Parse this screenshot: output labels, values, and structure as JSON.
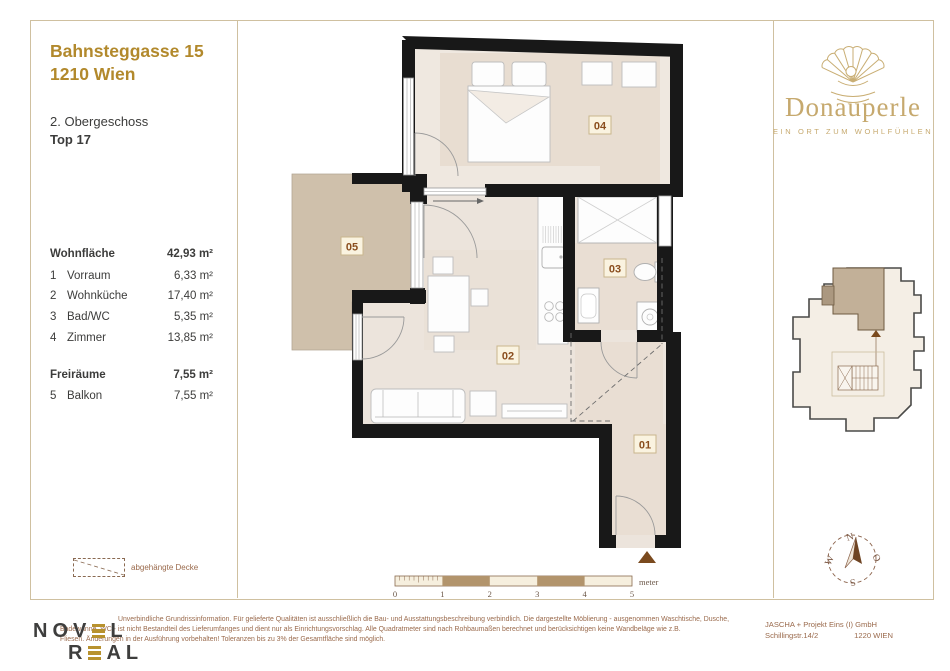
{
  "project": {
    "title1": "Bahnsteggasse 15",
    "title2": "1210 Wien",
    "floor": "2. Obergeschoss",
    "unit": "Top 17"
  },
  "brand": {
    "name": "Donauperle",
    "tagline": "EIN ORT ZUM WOHLFÜHLEN"
  },
  "areas": {
    "h1": {
      "label": "Wohnfläche",
      "value": "42,93 m²"
    },
    "rows": [
      {
        "no": "1",
        "label": "Vorraum",
        "value": "6,33 m²"
      },
      {
        "no": "2",
        "label": "Wohnküche",
        "value": "17,40 m²"
      },
      {
        "no": "3",
        "label": "Bad/WC",
        "value": "5,35 m²"
      },
      {
        "no": "4",
        "label": "Zimmer",
        "value": "13,85 m²"
      }
    ],
    "h2": {
      "label": "Freiräume",
      "value": "7,55 m²"
    },
    "rows2": [
      {
        "no": "5",
        "label": "Balkon",
        "value": "7,55 m²"
      }
    ]
  },
  "legend": {
    "label": "abgehängte Decke"
  },
  "plan": {
    "badges": [
      "01",
      "02",
      "03",
      "04",
      "05"
    ]
  },
  "scale": {
    "ticks": [
      "0",
      "1",
      "2",
      "3",
      "4",
      "5"
    ],
    "unit": "meter"
  },
  "compass": {
    "n": "N",
    "o": "O",
    "s": "S",
    "w": "W"
  },
  "footer": {
    "logo": {
      "l1a": "NOV",
      "l1b": "L",
      "l2a": "R",
      "l2b": "AL"
    },
    "disclaimer": [
      "Unverbindliche Grundrissinformation. Für gelieferte Qualitäten ist ausschließlich die Bau- und Ausstattungsbeschreibung verbindlich. Die dargestellte Möblierung - ausgenommen Waschtische, Dusche,",
      "Badewanne, WC - ist nicht Bestandteil des Lieferumfanges und dient nur als Einrichtungsvorschlag. Alle Quadratmeter sind nach Rohbaumaßen berechnet und berücksichtigen keine Wandbeläge wie z.B.",
      "Fliesen. Änderungen in der Ausführung vorbehalten! Toleranzen bis zu 3% der Gesamtfläche sind möglich."
    ],
    "company": {
      "name": "JASCHA + Projekt Eins (I) GmbH",
      "street": "Schillingstr.14/2",
      "city": "1220 WIEN"
    }
  },
  "colors": {
    "accent_gold": "#b2892c",
    "brand_gold": "#c6a96e",
    "wall_black": "#181818",
    "floor_beige": "#ece4dc",
    "balcony_tan": "#cfc0ab",
    "badge_brown": "#8a4d1d",
    "footer_brown": "#9a6a4c",
    "logo_bar_gold": "#b8922e"
  }
}
